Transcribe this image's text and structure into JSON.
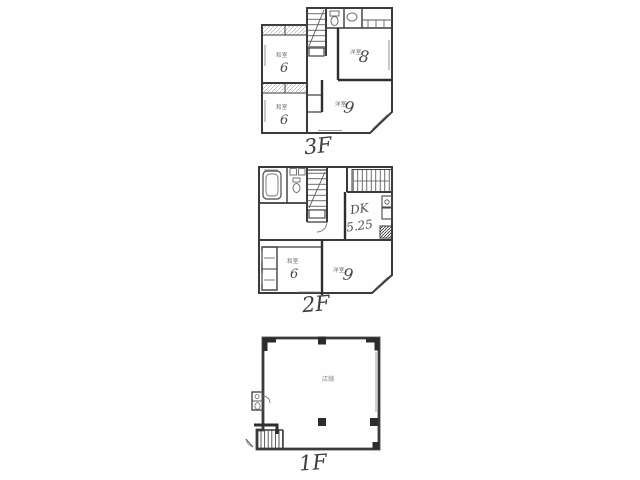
{
  "document": {
    "type": "floor-plan-scan",
    "colors": {
      "ink": "#3a3a3a",
      "thick_wall": "#2e2e2e",
      "pencil": "#474747",
      "fixture": "#6a6a6a",
      "background": "#fefefe",
      "frame": "#cdcdcd"
    }
  },
  "floors": [
    {
      "label": "3F",
      "rooms": [
        {
          "name": "和室",
          "size": "6"
        },
        {
          "name": "和室",
          "size": "6"
        },
        {
          "name": "洋室",
          "size": "8"
        },
        {
          "name": "洋室",
          "size": "9"
        }
      ]
    },
    {
      "label": "2F",
      "rooms": [
        {
          "name": "DK",
          "size": "5.25"
        },
        {
          "name": "和室",
          "size": "6"
        },
        {
          "name": "洋室",
          "size": "9"
        }
      ]
    },
    {
      "label": "1F",
      "rooms": [
        {
          "name": "店舗",
          "size": ""
        }
      ]
    }
  ]
}
